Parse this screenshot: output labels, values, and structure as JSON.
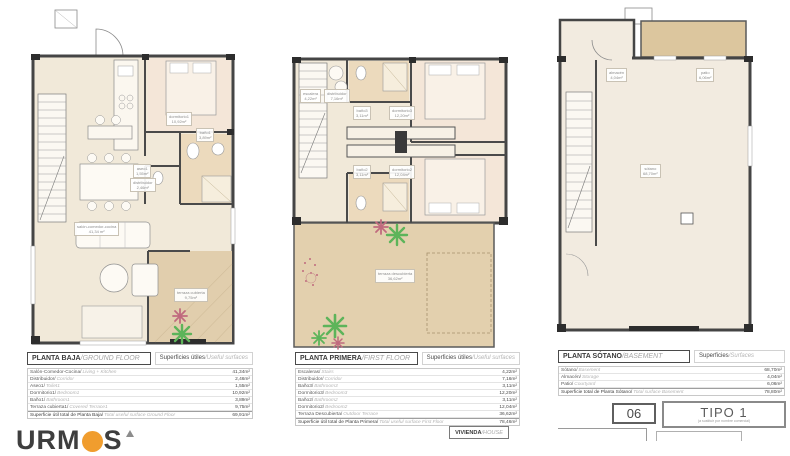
{
  "colors": {
    "wall": "#454545",
    "room_fill": "#f1e9d9",
    "bedroom_fill": "#f4e6d8",
    "tile_fill": "#ecdabd",
    "terrace_fill": "#e3d0ae",
    "plant_green": "#5db45a",
    "plant_red": "#c06a7e",
    "brand_orange": "#f09d2e"
  },
  "logo": {
    "text_left": "URM",
    "text_right": "S"
  },
  "plans": [
    {
      "title": "PLANTA BAJA",
      "title_en": "/GROUND FLOOR",
      "surfaces": "Superficies útiles",
      "surfaces_en": "/Useful surfaces",
      "room_labels": [
        {
          "name": "salón-comedor-cocina",
          "area": "41,34 m²"
        },
        {
          "name": "dormitorio1",
          "area": "10,92m²"
        },
        {
          "name": "baño1",
          "area": "3,89m²"
        },
        {
          "name": "aseo1",
          "area": "1,55m²"
        },
        {
          "name": "distribuidor",
          "area": "2,46m²"
        },
        {
          "name": "terraza cubierta",
          "area": "9,75m²"
        }
      ],
      "rows": [
        {
          "es": "Salón-Comedor-Cocina/",
          "en": "Living + Kitchen",
          "value": "41,34m²"
        },
        {
          "es": "Distribuidor/",
          "en": "Corridor",
          "value": "2,46m²"
        },
        {
          "es": "Aseo1/",
          "en": "Toilet1",
          "value": "1,55m²"
        },
        {
          "es": "Dormitorio1/",
          "en": "Bedroom1",
          "value": "10,92m²"
        },
        {
          "es": "Baño1/",
          "en": "Bathroom1",
          "value": "3,89m²"
        },
        {
          "es": "Terraza cubierta1/",
          "en": "Covered Terrace1",
          "value": "9,75m²"
        }
      ],
      "total": {
        "es": "Superficie útil total de Planta Baja/",
        "en": "Total useful surface Ground Floor",
        "value": "69,91m²"
      }
    },
    {
      "title": "PLANTA PRIMERA",
      "title_en": "/FIRST FLOOR",
      "surfaces": "Superficies útiles",
      "surfaces_en": "/Useful surfaces",
      "room_labels": [
        {
          "name": "escalera",
          "area": "4,22m²"
        },
        {
          "name": "distribuidor",
          "area": "7,16m²"
        },
        {
          "name": "baño3",
          "area": "3,11m²"
        },
        {
          "name": "dormitorio3",
          "area": "12,20m²"
        },
        {
          "name": "baño2",
          "area": "3,11m²"
        },
        {
          "name": "dormitorio2",
          "area": "12,04m²"
        },
        {
          "name": "terraza descubierta",
          "area": "36,62m²"
        }
      ],
      "rows": [
        {
          "es": "Escaleras/",
          "en": "Stairs",
          "value": "4,22m²"
        },
        {
          "es": "Distribuidor/",
          "en": "Corridor",
          "value": "7,16m²"
        },
        {
          "es": "Baño3/",
          "en": "Bathroom3",
          "value": "3,11m²"
        },
        {
          "es": "Dormitorio3/",
          "en": "Bedroom3",
          "value": "12,20m²"
        },
        {
          "es": "Baño2/",
          "en": "Bathroom2",
          "value": "3,11m²"
        },
        {
          "es": "Dormitorio2/",
          "en": "Bedroom2",
          "value": "12,04m²"
        },
        {
          "es": "Terraza Descubierta/",
          "en": "Outdoor Terrace",
          "value": "36,62m²"
        }
      ],
      "total": {
        "es": "Superficie útil total de Planta Primera/",
        "en": "Total useful surface First Floor",
        "value": "78,46m²"
      }
    },
    {
      "title": "PLANTA SÓTANO",
      "title_en": "/BASEMENT",
      "surfaces": "Superficies",
      "surfaces_en": "/Surfaces",
      "room_labels": [
        {
          "name": "almacén",
          "area": "4,04m²"
        },
        {
          "name": "patio",
          "area": "6,06m²"
        },
        {
          "name": "sótano",
          "area": "68,70m²"
        }
      ],
      "rows": [
        {
          "es": "Sótano/",
          "en": "Basement",
          "value": "68,70m²"
        },
        {
          "es": "Almacén/",
          "en": "Storage",
          "value": "4,04m²"
        },
        {
          "es": "Patio/",
          "en": "Courtyard",
          "value": "6,06m²"
        }
      ],
      "total": {
        "es": "Superficie total de Planta Sótano/",
        "en": "Total surface Basement",
        "value": "78,80m²"
      }
    }
  ],
  "footer": {
    "vivienda": "VIVIENDA",
    "vivienda_en": "/HOUSE",
    "sheet_number": "06",
    "type_label": "TIPO 1",
    "type_sub": "(a sustituir por nombre comercial)"
  }
}
